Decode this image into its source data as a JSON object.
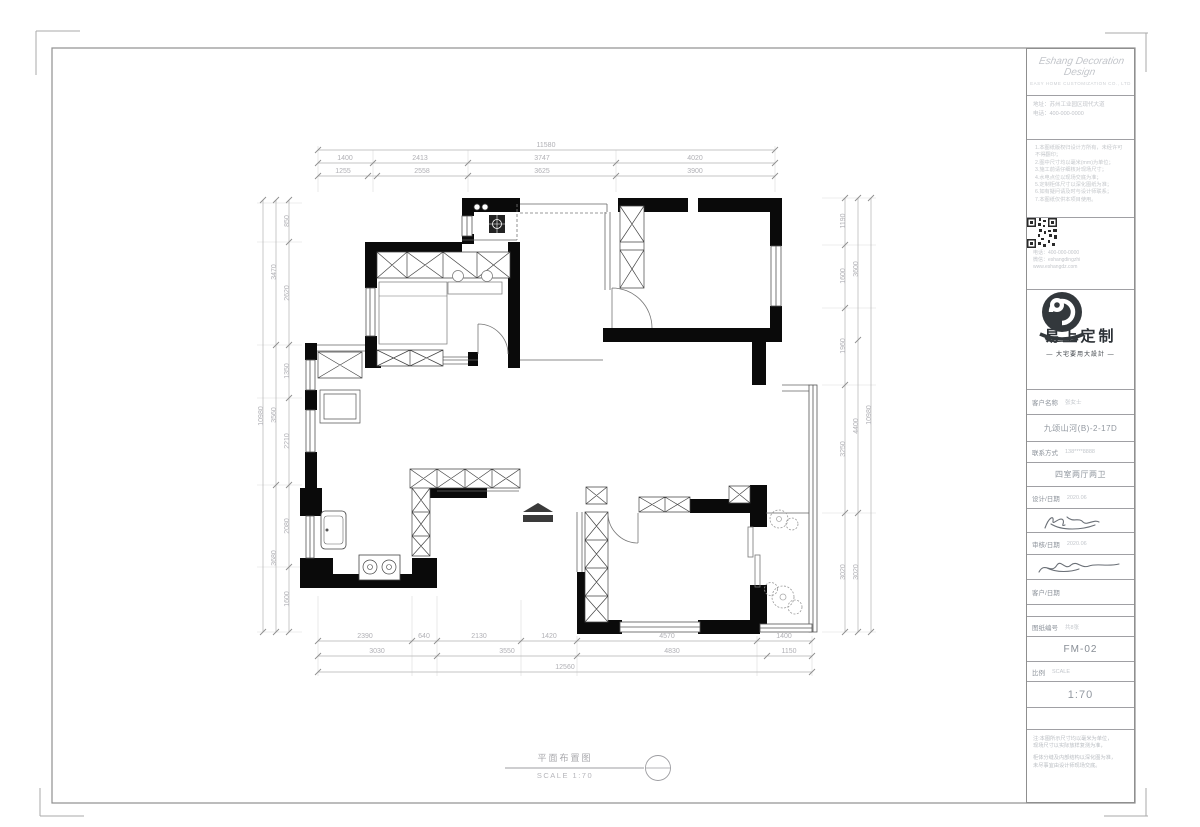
{
  "title_block": {
    "company_script": "Eshang Decoration Design",
    "company_sub": "EASY HOME CUSTOMIZATION CO., LTD",
    "contact_line1": "地址：苏州工业园区现代大道",
    "contact_line2": "电话：400-000-0000",
    "paragraph": [
      "1.本图纸版权归设计方所有，未经许可不得翻印；",
      "2.图中尺寸均以毫米(mm)为单位；",
      "3.施工前请仔细核对现场尺寸；",
      "4.水电点位以现场交底为准；",
      "5.定制柜体尺寸以深化图纸为准；",
      "6.如有疑问请及时与设计师联系；",
      "7.本图纸仅供本项目使用。"
    ],
    "qr_lines_right_1": "扫码关注",
    "qr_lines_right_2": "易上定制",
    "qr_lines_right_3": "了解更多",
    "qr_below_1": "电话：400-000-0000",
    "qr_below_2": "微信：eshangdingzhi",
    "qr_below_3": "www.eshangdz.com",
    "brand_name": "易上定制",
    "brand_tagline": "— 大宅要用大設計 —",
    "fields": {
      "f1_label": "客户名称",
      "f1_value": "张女士",
      "f2_value": "九颂山河(B)-2-17D",
      "f3_label": "联系方式",
      "f3_value": "138****8888",
      "f4_value": "四室两厅两卫",
      "f5_label": "设计/日期",
      "f5_value": "2020.06",
      "f6_label": "审核/日期",
      "f6_value": "2020.06",
      "f7_label": "客户/日期",
      "f7_value": "",
      "f8_label": "图纸编号",
      "f8_value": "共8张",
      "f9_value": "FM-02",
      "f10_label": "比例",
      "f10_value": "SCALE",
      "f11_value": "1:70"
    },
    "footer_notes": [
      "注:本图所示尺寸均以毫米为单位，",
      "现场尺寸以实际放样复测为准，",
      "柜体分缝及内部结构以深化图为准，",
      "未尽事宜由设计师现场交底。"
    ]
  },
  "drawing_title": {
    "label": "平面布置图",
    "scale_text": "SCALE 1:70"
  },
  "plan": {
    "dims": [
      {
        "x": 546,
        "y": 147,
        "t": "11580"
      },
      {
        "x": 345,
        "y": 160,
        "t": "1400"
      },
      {
        "x": 420,
        "y": 160,
        "t": "2413"
      },
      {
        "x": 542,
        "y": 160,
        "t": "3747"
      },
      {
        "x": 695,
        "y": 160,
        "t": "4020"
      },
      {
        "x": 343,
        "y": 173,
        "t": "1255"
      },
      {
        "x": 422,
        "y": 173,
        "t": "2558"
      },
      {
        "x": 542,
        "y": 173,
        "t": "3625"
      },
      {
        "x": 695,
        "y": 173,
        "t": "3900"
      },
      {
        "x": 365,
        "y": 638,
        "t": "2390"
      },
      {
        "x": 424,
        "y": 638,
        "t": "640"
      },
      {
        "x": 479,
        "y": 638,
        "t": "2130"
      },
      {
        "x": 549,
        "y": 638,
        "t": "1420"
      },
      {
        "x": 667,
        "y": 638,
        "t": "4570"
      },
      {
        "x": 784,
        "y": 638,
        "t": "1400"
      },
      {
        "x": 377,
        "y": 653,
        "t": "3030"
      },
      {
        "x": 507,
        "y": 653,
        "t": "3550"
      },
      {
        "x": 672,
        "y": 653,
        "t": "4830"
      },
      {
        "x": 789,
        "y": 653,
        "t": "1150"
      },
      {
        "x": 565,
        "y": 669,
        "t": "12560"
      },
      {
        "x": 289,
        "y": 221,
        "t": "850",
        "r": 1
      },
      {
        "x": 289,
        "y": 293,
        "t": "2620",
        "r": 1
      },
      {
        "x": 289,
        "y": 371,
        "t": "1350",
        "r": 1
      },
      {
        "x": 289,
        "y": 441,
        "t": "2210",
        "r": 1
      },
      {
        "x": 289,
        "y": 526,
        "t": "2080",
        "r": 1
      },
      {
        "x": 289,
        "y": 599,
        "t": "1600",
        "r": 1
      },
      {
        "x": 276,
        "y": 272,
        "t": "3470",
        "r": 1
      },
      {
        "x": 276,
        "y": 415,
        "t": "3560",
        "r": 1
      },
      {
        "x": 276,
        "y": 558,
        "t": "3680",
        "r": 1
      },
      {
        "x": 263,
        "y": 416,
        "t": "10980",
        "r": 1
      },
      {
        "x": 845,
        "y": 221,
        "t": "1190",
        "r": 1
      },
      {
        "x": 845,
        "y": 276,
        "t": "1600",
        "r": 1
      },
      {
        "x": 845,
        "y": 346,
        "t": "1960",
        "r": 1
      },
      {
        "x": 845,
        "y": 449,
        "t": "3250",
        "r": 1
      },
      {
        "x": 845,
        "y": 572,
        "t": "3020",
        "r": 1
      },
      {
        "x": 858,
        "y": 269,
        "t": "3600",
        "r": 1
      },
      {
        "x": 858,
        "y": 426,
        "t": "4400",
        "r": 1
      },
      {
        "x": 858,
        "y": 572,
        "t": "3020",
        "r": 1
      },
      {
        "x": 871,
        "y": 415,
        "t": "10980",
        "r": 1
      }
    ]
  }
}
